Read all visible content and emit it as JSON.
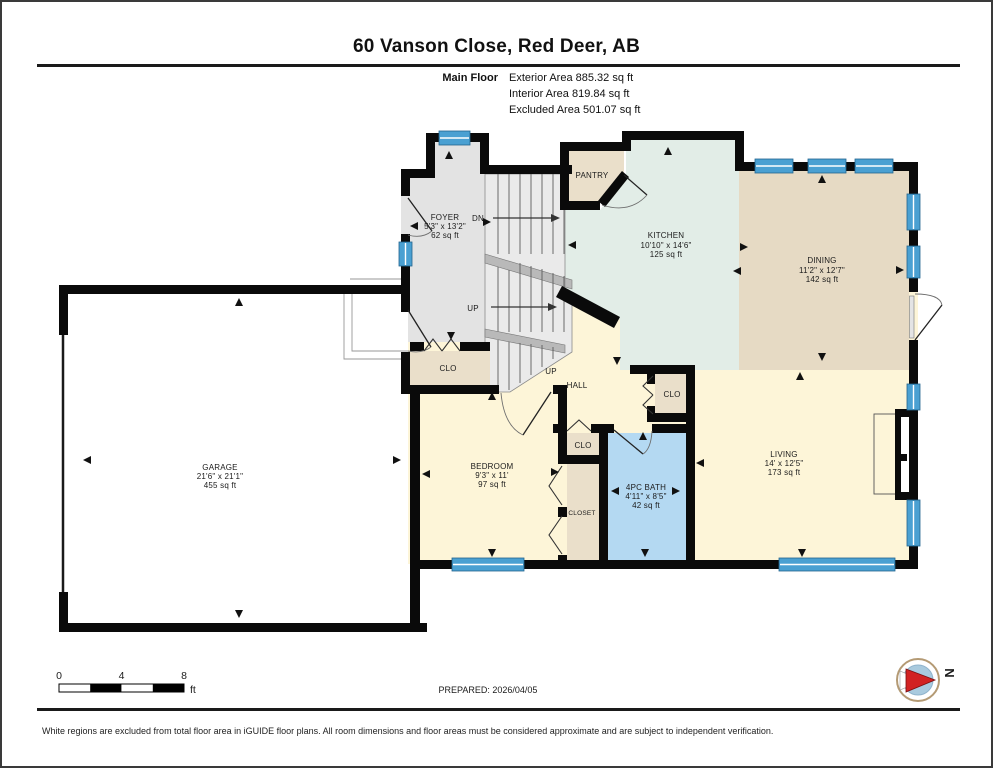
{
  "header": {
    "title": "60 Vanson Close, Red Deer, AB",
    "floor_label": "Main Floor",
    "areas": {
      "exterior": "Exterior Area 885.32 sq ft",
      "interior": "Interior Area 819.84 sq ft",
      "excluded": "Excluded Area 501.07 sq ft"
    }
  },
  "rooms": {
    "foyer": {
      "name": "FOYER",
      "dims": "5'3\" x 13'2\"",
      "area": "62 sq ft"
    },
    "pantry": {
      "name": "PANTRY"
    },
    "kitchen": {
      "name": "KITCHEN",
      "dims": "10'10\" x 14'6\"",
      "area": "125 sq ft"
    },
    "dining": {
      "name": "DINING",
      "dims": "11'2\" x 12'7\"",
      "area": "142 sq ft"
    },
    "garage": {
      "name": "GARAGE",
      "dims": "21'6\" x 21'1\"",
      "area": "455 sq ft"
    },
    "bedroom": {
      "name": "BEDROOM",
      "dims": "9'3\" x 11'",
      "area": "97 sq ft"
    },
    "bath": {
      "name": "4PC BATH",
      "dims": "4'11\" x 8'5\"",
      "area": "42 sq ft"
    },
    "living": {
      "name": "LIVING",
      "dims": "14' x 12'5\"",
      "area": "173 sq ft"
    },
    "hall": {
      "name": "HALL"
    },
    "closet_foyer": {
      "name": "CLO"
    },
    "closet_hall": {
      "name": "CLO"
    },
    "closet_mid": {
      "name": "CLO"
    },
    "closet_bedroom": {
      "name": "CLOSET"
    }
  },
  "stairs": {
    "up_label": "UP",
    "down_label": "DN"
  },
  "footer": {
    "scale": {
      "zero": "0",
      "four": "4",
      "eight": "8",
      "unit": "ft"
    },
    "prepared": "PREPARED: 2026/04/05",
    "compass_north": "N",
    "disclaimer": "White regions are excluded from total floor area in iGUIDE floor plans. All room dimensions and floor areas must be considered approximate and are subject to independent verification."
  },
  "colors": {
    "wall": "#0a0a0a",
    "window": "#4aa0d2",
    "kitchen": "#e2ede7",
    "dining": "#e6dac4",
    "closet": "#eadfca",
    "floor_cream": "#fdf5d8",
    "bath": "#b4d9f2",
    "foyer_gray": "#e3e3e3",
    "garage": "#ffffff",
    "compass_red": "#d22222"
  }
}
